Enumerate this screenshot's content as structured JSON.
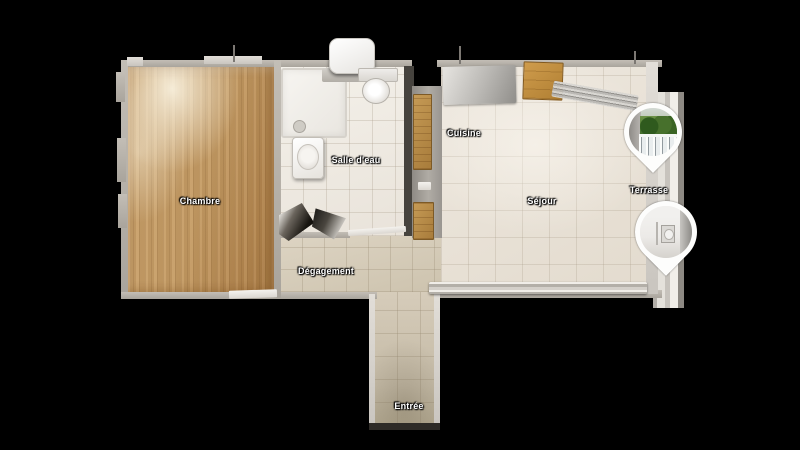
{
  "scene": {
    "type": "virtual-tour-floorplan-top-view",
    "background_color": "#000000"
  },
  "floorplan": {
    "rooms": [
      {
        "id": "chambre",
        "label": "Chambre",
        "floor": "wood-parquet"
      },
      {
        "id": "salle-deau",
        "label": "Salle d'eau",
        "floor": "white-tile"
      },
      {
        "id": "cuisine",
        "label": "Cuisine",
        "floor": "beige-tile"
      },
      {
        "id": "sejour",
        "label": "Séjour",
        "floor": "beige-tile"
      },
      {
        "id": "degagement",
        "label": "Dégagement",
        "floor": "beige-tile"
      },
      {
        "id": "entree",
        "label": "Entrée",
        "floor": "beige-tile"
      },
      {
        "id": "terrasse",
        "label": "Terrasse",
        "floor": "concrete"
      }
    ],
    "markers": [
      {
        "id": "pano-marker-terrace",
        "preview": "balcony railing with green trees",
        "shape": "teardrop-pin"
      },
      {
        "id": "pano-marker-interior",
        "preview": "white interior hallway with appliance",
        "shape": "teardrop-pin"
      }
    ],
    "fixtures": [
      "water-heater",
      "toilet",
      "shower-tray",
      "washbasin",
      "dark-vanity",
      "kitchen-counter",
      "wood-boards",
      "grey-worktop",
      "cardboard-box",
      "drying-rack",
      "radiator",
      "door-threshold"
    ],
    "colors": {
      "wood_floor": "#c69c64",
      "white_tile": "#ece7df",
      "hall_tile": "#d6cdbb",
      "wall": "#c3beb6",
      "label_text": "#ffffff",
      "marker_ring": "#ffffff",
      "trees_green": "#47702c"
    }
  }
}
